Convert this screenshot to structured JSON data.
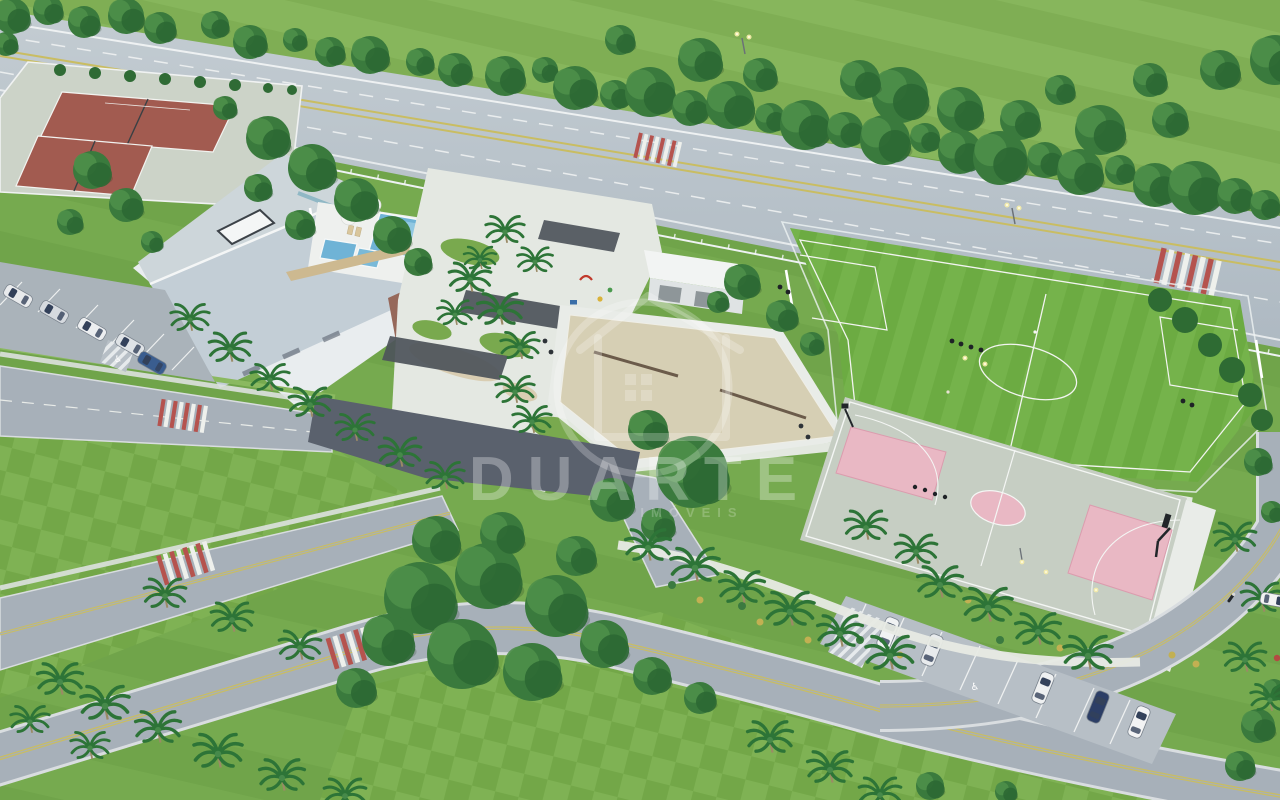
{
  "watermark": {
    "brand": "DUARTE",
    "tagline": "IMÓVEIS"
  },
  "icons": {
    "handicap": "♿"
  },
  "scene": {
    "type": "aerial-3d-architectural-render",
    "areas": [
      "perimeter-highway",
      "roadside-tree-belt",
      "tennis-courts",
      "clubhouse",
      "pool-deck",
      "swimming-pools",
      "central-garden",
      "playground",
      "pergolas",
      "support-kiosk",
      "beach-volleyball-courts",
      "soccer-field",
      "basketball-court",
      "street-parking-left",
      "street-parking-right",
      "internal-avenue",
      "pedestrian-crosswalks",
      "palm-lined-median",
      "checkered-lawns"
    ]
  },
  "palette": {
    "lawn": "#6ea047",
    "soccer_green": "#6cab42",
    "highway": "#b6c0c8",
    "road": "#a7b0b9",
    "asphalt": "#5a616d",
    "clay_court": "#a25b50",
    "sand": "#d6cfb4",
    "pool_water": "#6fb3d6",
    "court_pink": "#e9b8c4",
    "sport_court": "#c6cec3",
    "crosswalk_red": "#b5534e",
    "tree": "#3a7a3d",
    "palm": "#2d7437",
    "wood_deck": "#cdb990",
    "roof": "#c3ced6",
    "paving_white": "#eef0ee",
    "lane_yellow": "#c9bd62"
  }
}
